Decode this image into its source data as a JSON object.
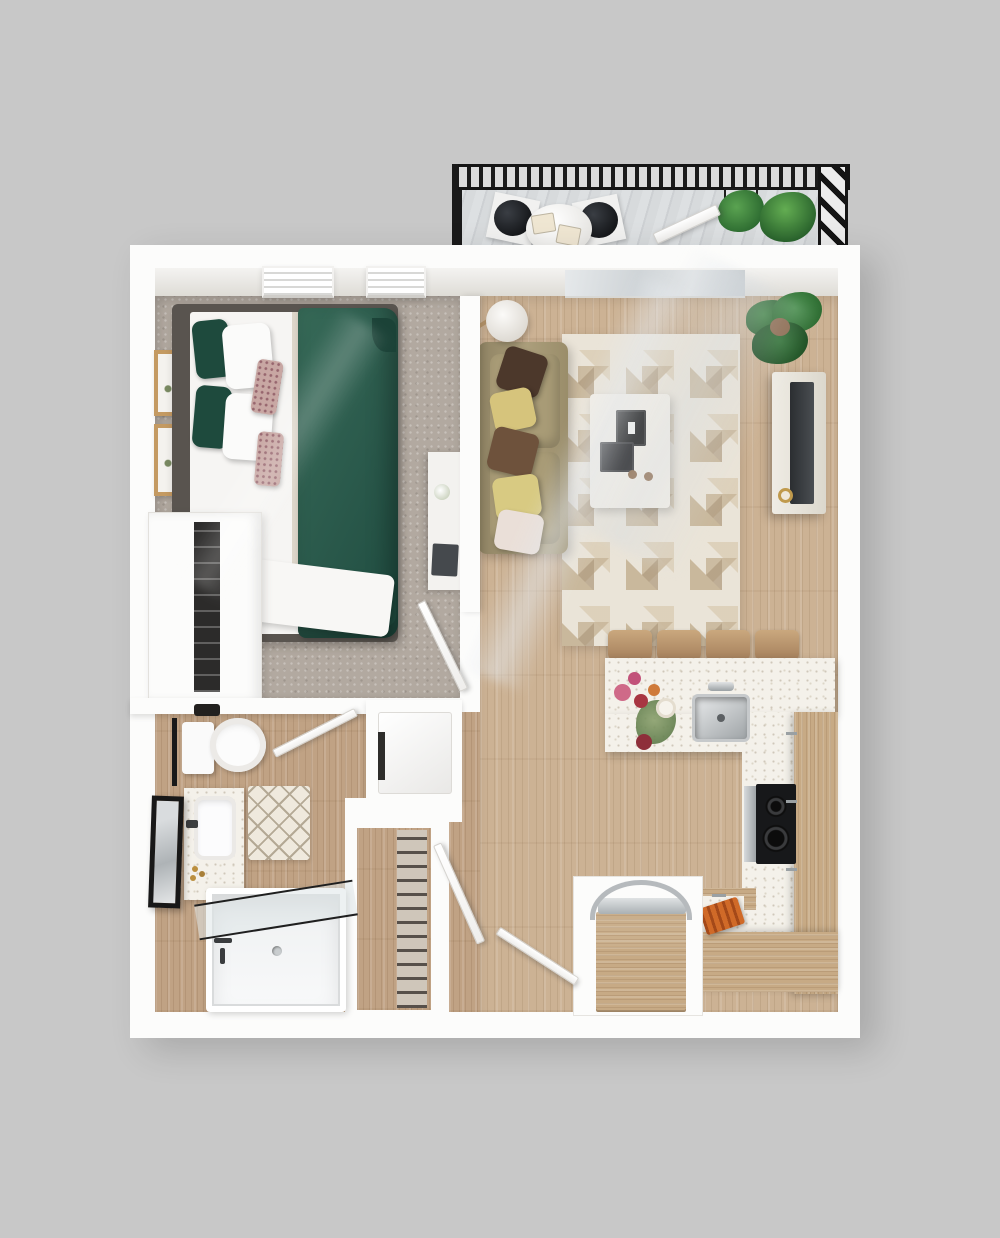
{
  "scene": {
    "kind": "3d-top-down-floor-plan-render",
    "unit_type": "one-bedroom-apartment-with-balcony",
    "background": "#c8c8c8",
    "text_labels_visible": false
  },
  "palette": {
    "bg": "#c8c8c8",
    "wall": "#fcfcfb",
    "wallshade": "#e3e1dd",
    "carpet": "#b2a9a0",
    "woodliving": "#ccb294",
    "woodwarm": "#c0a284",
    "speckle": "#f4f1ea",
    "cabinet": "#c7aa85",
    "sofa": "#a69a77",
    "duvet": "#2c5c4e",
    "rugbase": "#eae4d8",
    "rugaccent": "#c9b89c",
    "railing": "#181818",
    "deck": "#d6d8da",
    "plant": "#38743b",
    "steel": "#b9bdc0",
    "ink": "#1c1c1c",
    "gold": "#c09a4c",
    "pillow_brown": "#4c382b",
    "pillow_yellow": "#d6c47c",
    "pillow_blush": "#eadfd8"
  },
  "rooms": [
    {
      "name": "balcony",
      "items": [
        "black-metal-railing",
        "diagonal-plank-deck",
        "round-bistro-table",
        "cafe-chairs",
        "potted-plants",
        "open-glass-door"
      ]
    },
    {
      "name": "bedroom",
      "items": [
        "double-bed-green-duvet",
        "dark-headboard",
        "accent-pillows",
        "nightstand-with-clock",
        "framed-artworks",
        "windows",
        "wall-desk",
        "open-wardrobe"
      ]
    },
    {
      "name": "living-room",
      "items": [
        "olive-sofa-with-pillows",
        "floor-lamp",
        "geometric-area-rug",
        "white-coffee-table",
        "tv-sideboard",
        "fiddle-leaf-plant",
        "balcony-glazing"
      ]
    },
    {
      "name": "kitchen",
      "items": [
        "quartz-breakfast-bar",
        "bar-stools",
        "stainless-sink",
        "black-cooktop",
        "tall-wood-cabinets",
        "refrigerator-with-arc-handle",
        "flower-arrangement",
        "cutting-board"
      ]
    },
    {
      "name": "bathroom",
      "items": [
        "toilet",
        "vanity-with-sink",
        "leaning-mirror",
        "towel-rail",
        "diamond-bath-mat",
        "tub-with-glass-screen"
      ]
    },
    {
      "name": "entry-hall",
      "items": [
        "laundry-closet-washer",
        "wire-shelf-closet",
        "entry-door",
        "interior-doors"
      ]
    }
  ],
  "counts": {
    "bar_stools": 4,
    "cafe_chairs": 2,
    "sofa_pillows": 5,
    "framed_artworks": 2,
    "balcony_plants": 2,
    "bedroom_windows": 2
  }
}
